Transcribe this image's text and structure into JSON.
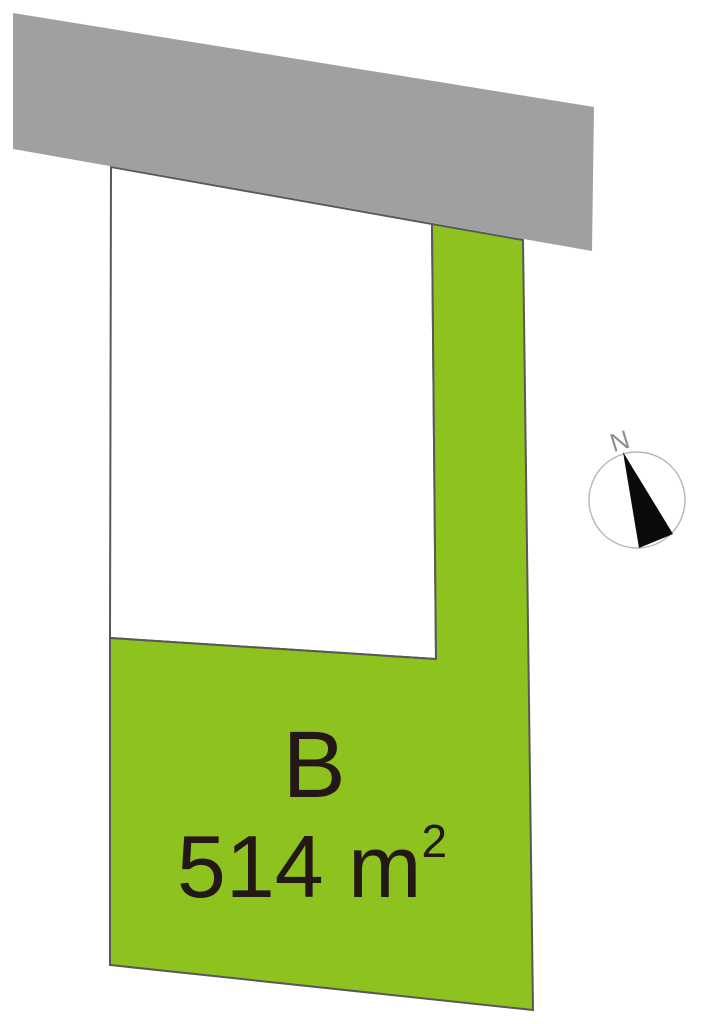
{
  "lots": {
    "b": {
      "label": "B",
      "area_text": "514 m",
      "area_exponent": "2"
    }
  },
  "compass": {
    "north_label": "N"
  },
  "colors": {
    "background": "#ffffff",
    "road_fill": "#9fa0a0",
    "adjacent_lot_fill": "#ffffff",
    "lot_b_fill": "#8dc21f",
    "lot_outline": "#595757",
    "label_text": "#231815",
    "needle_fill": "#0b0b0b",
    "compass_ring": "#b5b5b6",
    "north_label_color": "#8f8f8f"
  }
}
